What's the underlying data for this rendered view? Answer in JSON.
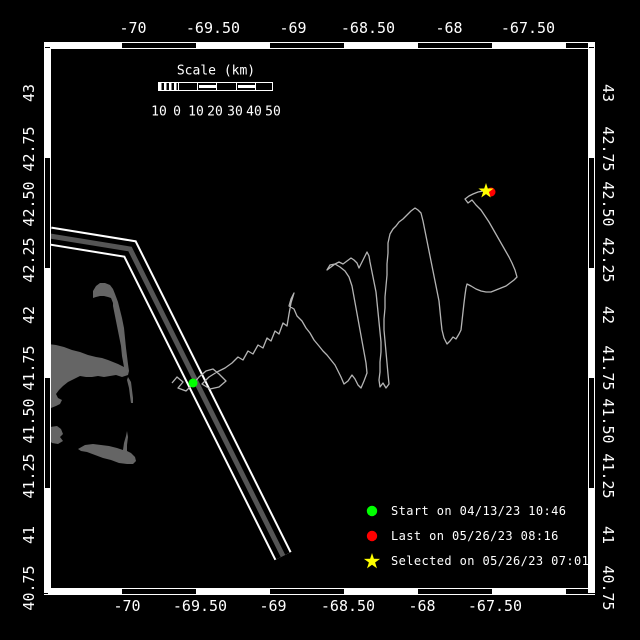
{
  "colors": {
    "background": "#000000",
    "frame": "#ffffff",
    "text": "#ffffff",
    "land": "#656565",
    "lane_core": "#555555",
    "lane_edge": "#ffffff",
    "track": "#b4b4b4",
    "start_marker": "#00ff00",
    "last_marker": "#ff0000",
    "selected_marker": "#ffff00"
  },
  "axes": {
    "top": [
      {
        "label": "-70",
        "x": 133
      },
      {
        "label": "-69.50",
        "x": 213
      },
      {
        "label": "-69",
        "x": 293
      },
      {
        "label": "-68.50",
        "x": 368
      },
      {
        "label": "-68",
        "x": 449
      },
      {
        "label": "-67.50",
        "x": 528
      }
    ],
    "bottom": [
      {
        "label": "-70",
        "x": 127
      },
      {
        "label": "-69.50",
        "x": 200
      },
      {
        "label": "-69",
        "x": 273
      },
      {
        "label": "-68.50",
        "x": 348
      },
      {
        "label": "-68",
        "x": 422
      },
      {
        "label": "-67.50",
        "x": 495
      }
    ],
    "left": [
      {
        "label": "43",
        "y": 93
      },
      {
        "label": "42.75",
        "y": 149
      },
      {
        "label": "42.50",
        "y": 204
      },
      {
        "label": "42.25",
        "y": 260
      },
      {
        "label": "42",
        "y": 315
      },
      {
        "label": "41.75",
        "y": 368
      },
      {
        "label": "41.50",
        "y": 421
      },
      {
        "label": "41.25",
        "y": 476
      },
      {
        "label": "41",
        "y": 535
      },
      {
        "label": "40.75",
        "y": 588
      }
    ],
    "right": [
      {
        "label": "43",
        "y": 93
      },
      {
        "label": "42.75",
        "y": 149
      },
      {
        "label": "42.50",
        "y": 204
      },
      {
        "label": "42.25",
        "y": 260
      },
      {
        "label": "42",
        "y": 315
      },
      {
        "label": "41.75",
        "y": 368
      },
      {
        "label": "41.50",
        "y": 421
      },
      {
        "label": "41.25",
        "y": 476
      },
      {
        "label": "41",
        "y": 535
      },
      {
        "label": "40.75",
        "y": 588
      }
    ]
  },
  "scale_bar": {
    "title": "Scale (km)",
    "labels": [
      {
        "text": "10",
        "x": 159
      },
      {
        "text": "0",
        "x": 177
      },
      {
        "text": "10",
        "x": 196
      },
      {
        "text": "20",
        "x": 215
      },
      {
        "text": "30",
        "x": 235
      },
      {
        "text": "40",
        "x": 254
      },
      {
        "text": "50",
        "x": 273
      }
    ],
    "bar": {
      "left": 158,
      "top": 82,
      "width": 115,
      "height": 9,
      "hatch_width": 19,
      "cell_width": 19.2,
      "filled_cells": [
        1,
        3
      ]
    },
    "title_pos": {
      "x": 216,
      "y": 71
    },
    "labels_y": 112
  },
  "legend": {
    "items": [
      {
        "marker": "circle",
        "color": "#00ff00",
        "label": "Start on 04/13/23 10:46"
      },
      {
        "marker": "circle",
        "color": "#ff0000",
        "label": "Last on 05/26/23 08:16"
      },
      {
        "marker": "star",
        "color": "#ffff00",
        "label": "Selected on 05/26/23 07:01"
      }
    ]
  },
  "map": {
    "frame": {
      "outer": [
        44,
        42,
        596,
        595
      ],
      "inner": [
        51,
        49,
        589,
        588
      ]
    },
    "lane": {
      "path": "M50,236 L130,249 L283,556",
      "total_width": 19,
      "gap_width": 15,
      "core_width": 5
    },
    "land_paths": [
      "M48,344 L56,345 L64,347 L72,350 L80,352 L88,355 L96,357 L102,358 L108,360 L113,362 L118,364 L122,366 L124,367 L122,356 L121,346 L119,336 L117,326 L115,316 L113,306 L113,303 L111,298 L108,297 L104,296 L100,296 L96,297 L93,298 L93,291 L96,286 L100,283 L105,283 L110,285 L113,289 L115,294 L118,302 L120,310 L122,318 L124,328 L125,338 L126,348 L127,356 L128,364 L129,371 L128,375 L122,377 L116,375 L110,376 L104,377 L98,376 L92,377 L86,377 L80,376 L74,379 L68,382 L63,386 L59,390 L56,394 L58,398 L62,400 L60,404 L56,406 L51,408 L48,410 Z",
      "M128,377 L131,382 L132,390 L133,398 L133,403 L131,403 L130,396 L129,388 L127,380 Z",
      "M50,427 L57,426 L61,429 L63,434 L60,437 L63,441 L58,444 L52,443 L49,440 L51,435 L49,431 Z",
      "M78,449 L85,445 L93,444 L101,445 L109,446 L117,448 L123,450 L124,443 L126,436 L127,431 L128,437 L127,445 L127,451 L131,453 L135,457 L136,461 L133,464 L127,464 L119,463 L111,460 L103,458 L95,455 L87,452 L81,451 Z"
    ],
    "track": {
      "points": [
        [
          172,
          383
        ],
        [
          177,
          377
        ],
        [
          183,
          382
        ],
        [
          178,
          388
        ],
        [
          186,
          391
        ],
        [
          193,
          384
        ],
        [
          199,
          377
        ],
        [
          206,
          371
        ],
        [
          213,
          369
        ],
        [
          219,
          374
        ],
        [
          226,
          381
        ],
        [
          219,
          387
        ],
        [
          210,
          389
        ],
        [
          202,
          384
        ],
        [
          209,
          377
        ],
        [
          217,
          372
        ],
        [
          225,
          368
        ],
        [
          232,
          363
        ],
        [
          238,
          357
        ],
        [
          243,
          360
        ],
        [
          248,
          351
        ],
        [
          253,
          354
        ],
        [
          258,
          345
        ],
        [
          263,
          348
        ],
        [
          267,
          338
        ],
        [
          271,
          341
        ],
        [
          275,
          331
        ],
        [
          279,
          334
        ],
        [
          283,
          323
        ],
        [
          287,
          326
        ],
        [
          289,
          314
        ],
        [
          291,
          303
        ],
        [
          294,
          293
        ],
        [
          291,
          299
        ],
        [
          289,
          306
        ],
        [
          294,
          309
        ],
        [
          297,
          316
        ],
        [
          302,
          321
        ],
        [
          306,
          328
        ],
        [
          310,
          333
        ],
        [
          314,
          340
        ],
        [
          319,
          346
        ],
        [
          323,
          351
        ],
        [
          327,
          355
        ],
        [
          331,
          360
        ],
        [
          335,
          365
        ],
        [
          338,
          371
        ],
        [
          341,
          377
        ],
        [
          344,
          384
        ],
        [
          348,
          381
        ],
        [
          352,
          375
        ],
        [
          355,
          379
        ],
        [
          358,
          385
        ],
        [
          361,
          388
        ],
        [
          364,
          381
        ],
        [
          367,
          373
        ],
        [
          366,
          363
        ],
        [
          364,
          352
        ],
        [
          362,
          341
        ],
        [
          360,
          330
        ],
        [
          358,
          319
        ],
        [
          356,
          308
        ],
        [
          354,
          297
        ],
        [
          352,
          286
        ],
        [
          349,
          277
        ],
        [
          345,
          271
        ],
        [
          340,
          267
        ],
        [
          335,
          264
        ],
        [
          330,
          265
        ],
        [
          327,
          270
        ],
        [
          331,
          267
        ],
        [
          335,
          264
        ],
        [
          339,
          262
        ],
        [
          343,
          264
        ],
        [
          347,
          261
        ],
        [
          351,
          258
        ],
        [
          354,
          260
        ],
        [
          357,
          263
        ],
        [
          359,
          268
        ],
        [
          361,
          264
        ],
        [
          364,
          258
        ],
        [
          367,
          252
        ],
        [
          369,
          256
        ],
        [
          370,
          262
        ],
        [
          372,
          272
        ],
        [
          374,
          282
        ],
        [
          376,
          292
        ],
        [
          377,
          302
        ],
        [
          378,
          312
        ],
        [
          379,
          322
        ],
        [
          380,
          332
        ],
        [
          381,
          342
        ],
        [
          381,
          352
        ],
        [
          380,
          362
        ],
        [
          380,
          372
        ],
        [
          379,
          380
        ],
        [
          380,
          387
        ],
        [
          383,
          383
        ],
        [
          386,
          388
        ],
        [
          389,
          384
        ],
        [
          388,
          374
        ],
        [
          387,
          363
        ],
        [
          386,
          352
        ],
        [
          385,
          341
        ],
        [
          384,
          330
        ],
        [
          384,
          319
        ],
        [
          385,
          308
        ],
        [
          385,
          297
        ],
        [
          386,
          286
        ],
        [
          387,
          275
        ],
        [
          387,
          264
        ],
        [
          388,
          253
        ],
        [
          388,
          243
        ],
        [
          390,
          234
        ],
        [
          393,
          229
        ],
        [
          396,
          226
        ],
        [
          399,
          222
        ],
        [
          403,
          219
        ],
        [
          407,
          215
        ],
        [
          411,
          211
        ],
        [
          415,
          208
        ],
        [
          418,
          210
        ],
        [
          421,
          213
        ],
        [
          423,
          221
        ],
        [
          425,
          231
        ],
        [
          427,
          241
        ],
        [
          429,
          251
        ],
        [
          431,
          261
        ],
        [
          433,
          271
        ],
        [
          435,
          281
        ],
        [
          437,
          291
        ],
        [
          439,
          301
        ],
        [
          440,
          311
        ],
        [
          441,
          321
        ],
        [
          442,
          330
        ],
        [
          444,
          338
        ],
        [
          447,
          344
        ],
        [
          450,
          341
        ],
        [
          453,
          337
        ],
        [
          456,
          339
        ],
        [
          459,
          334
        ],
        [
          461,
          330
        ],
        [
          462,
          321
        ],
        [
          463,
          312
        ],
        [
          464,
          303
        ],
        [
          465,
          295
        ],
        [
          466,
          288
        ],
        [
          467,
          284
        ],
        [
          471,
          286
        ],
        [
          476,
          289
        ],
        [
          481,
          291
        ],
        [
          486,
          292
        ],
        [
          491,
          292
        ],
        [
          496,
          290
        ],
        [
          501,
          288
        ],
        [
          506,
          286
        ],
        [
          510,
          283
        ],
        [
          514,
          280
        ],
        [
          517,
          277
        ],
        [
          515,
          270
        ],
        [
          512,
          263
        ],
        [
          509,
          257
        ],
        [
          505,
          250
        ],
        [
          501,
          243
        ],
        [
          497,
          236
        ],
        [
          493,
          229
        ],
        [
          489,
          222
        ],
        [
          485,
          216
        ],
        [
          481,
          210
        ],
        [
          476,
          205
        ],
        [
          472,
          200
        ],
        [
          468,
          203
        ],
        [
          465,
          199
        ],
        [
          469,
          196
        ],
        [
          473,
          194
        ],
        [
          478,
          192
        ],
        [
          483,
          191
        ],
        [
          486,
          191
        ]
      ]
    },
    "markers": {
      "start": {
        "x": 193,
        "y": 383,
        "r": 4.5
      },
      "last": {
        "x": 491,
        "y": 192,
        "r": 4.5
      },
      "selected": {
        "x": 486,
        "y": 191,
        "outer_r": 8,
        "inner_r": 3.1
      }
    }
  }
}
